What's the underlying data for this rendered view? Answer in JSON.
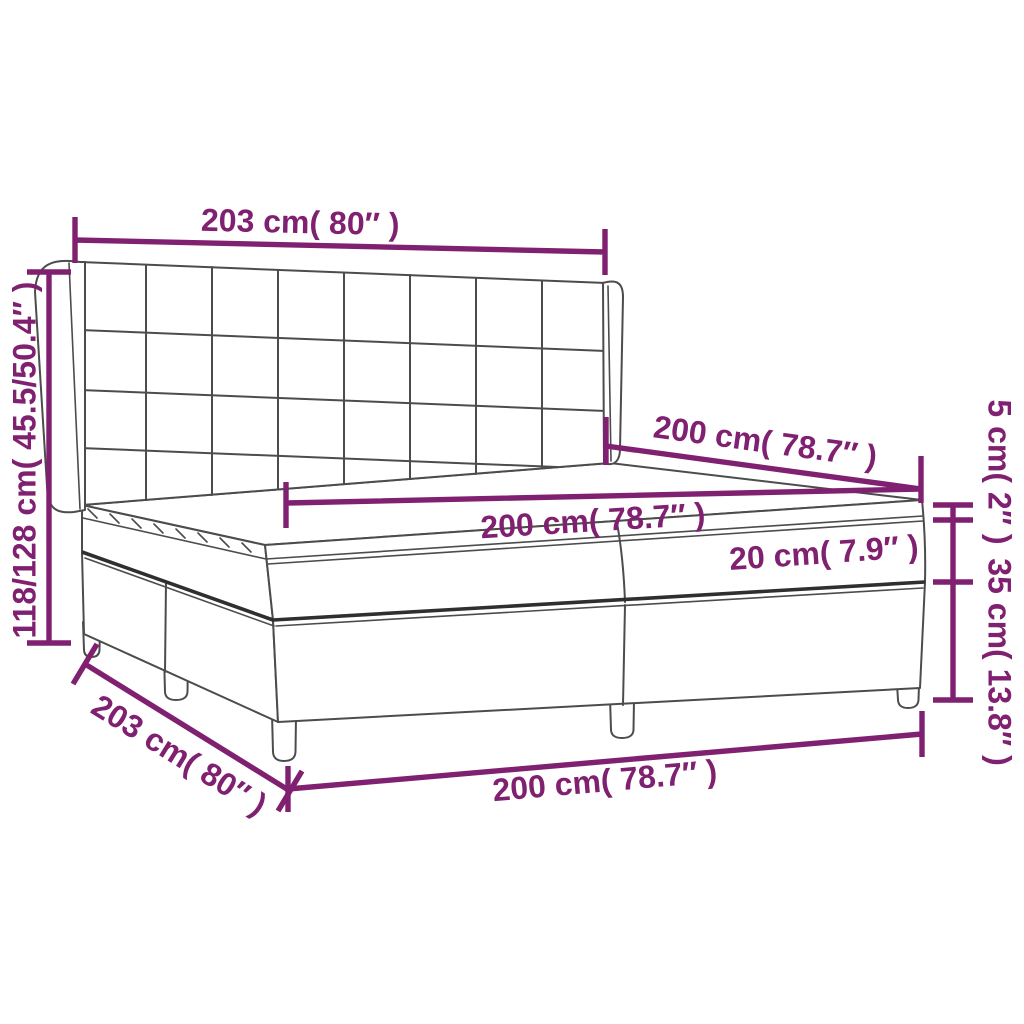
{
  "diagram": {
    "name": "Box spring bed with headboard, mattress and topper — dimension diagram",
    "accent_color": "#802070",
    "line_color": "#4c4c4c",
    "dims": {
      "headboard_width": "203 cm( 80″ )",
      "total_height": "118/128 cm( 45.5/50.4″ )",
      "mattress_length": "200 cm( 78.7″ )",
      "mattress_width": "200 cm( 78.7″ )",
      "mattress_height": "20 cm( 7.9″ )",
      "topper_height": "5 cm( 2″ )",
      "base_height": "35 cm( 13.8″ )",
      "base_length": "203 cm( 80″ )",
      "base_width": "200 cm( 78.7″ )"
    }
  }
}
